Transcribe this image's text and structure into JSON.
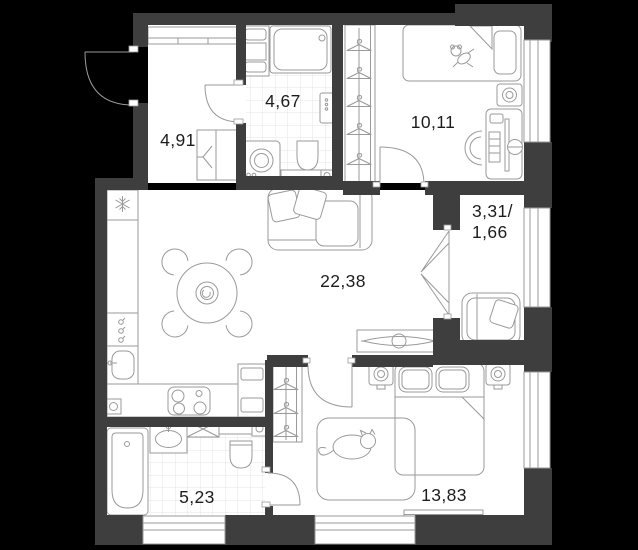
{
  "window": {
    "width": 638,
    "height": 550
  },
  "colors": {
    "background": "#000000",
    "wall": "#3e3e3e",
    "floor": "#ffffff",
    "furniture_line": "#9a9a9a",
    "tile_line": "#e4e4e4",
    "label_text": "#1d1d1d"
  },
  "plan": {
    "type": "apartment-floor-plan",
    "rooms": {
      "hallway": {
        "area_label": "4,91"
      },
      "bathroom_small": {
        "area_label": "4,67"
      },
      "kids_room": {
        "area_label": "10,11"
      },
      "loggia": {
        "area_label_line1": "3,31/",
        "area_label_line2": "1,66"
      },
      "living_kitchen": {
        "area_label": "22,38"
      },
      "bathroom_large": {
        "area_label": "5,23"
      },
      "bedroom": {
        "area_label": "13,83"
      }
    },
    "icons": {
      "fridge": "snowflake-icon",
      "wardrobes": "hanger-icon",
      "appliance_slot": "crossed-box-icon"
    }
  }
}
